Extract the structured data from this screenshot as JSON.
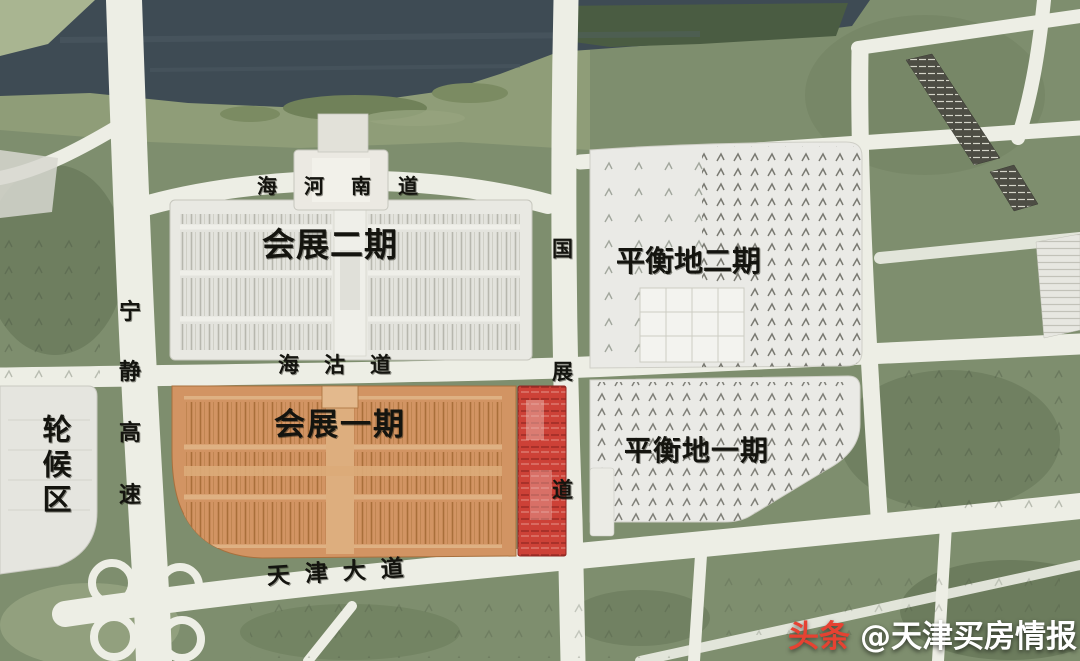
{
  "watermark": {
    "brand": "头条",
    "account": "@天津买房情报"
  },
  "areas": {
    "exhibition_phase2": {
      "label": "会展二期",
      "fill": "#e9e9e3"
    },
    "exhibition_phase1": {
      "label": "会展一期",
      "fill": "#d29463"
    },
    "balance_land_phase2": {
      "label": "平衡地二期",
      "fill": "#eaeae6"
    },
    "balance_land_phase1": {
      "label": "平衡地一期",
      "fill": "#eaeae6"
    },
    "waiting_area": {
      "label": "轮候区",
      "fill": "#e5e5df"
    },
    "reserved_red_strip": {
      "fill": "#cd4137"
    }
  },
  "roads": {
    "haihe_south_road": {
      "label": "海河南道"
    },
    "haigu_road": {
      "label": "海沽道"
    },
    "ningjing_expressway": {
      "label": "宁静高速",
      "chars": [
        "宁",
        "静",
        "高",
        "速"
      ]
    },
    "guozhan_road": {
      "label": "国展道",
      "chars": [
        "国",
        "展",
        "道"
      ]
    },
    "tianjin_avenue": {
      "label": "天津大道"
    }
  },
  "colors": {
    "water": "#3e4b54",
    "land_green": "#7e8e6e",
    "road_white": "#edeee5",
    "highlight_orange": "#d29463",
    "highlight_red": "#cd4137",
    "label_black": "#14140f",
    "watermark_red": "#e64232",
    "watermark_white": "#ffffff"
  }
}
